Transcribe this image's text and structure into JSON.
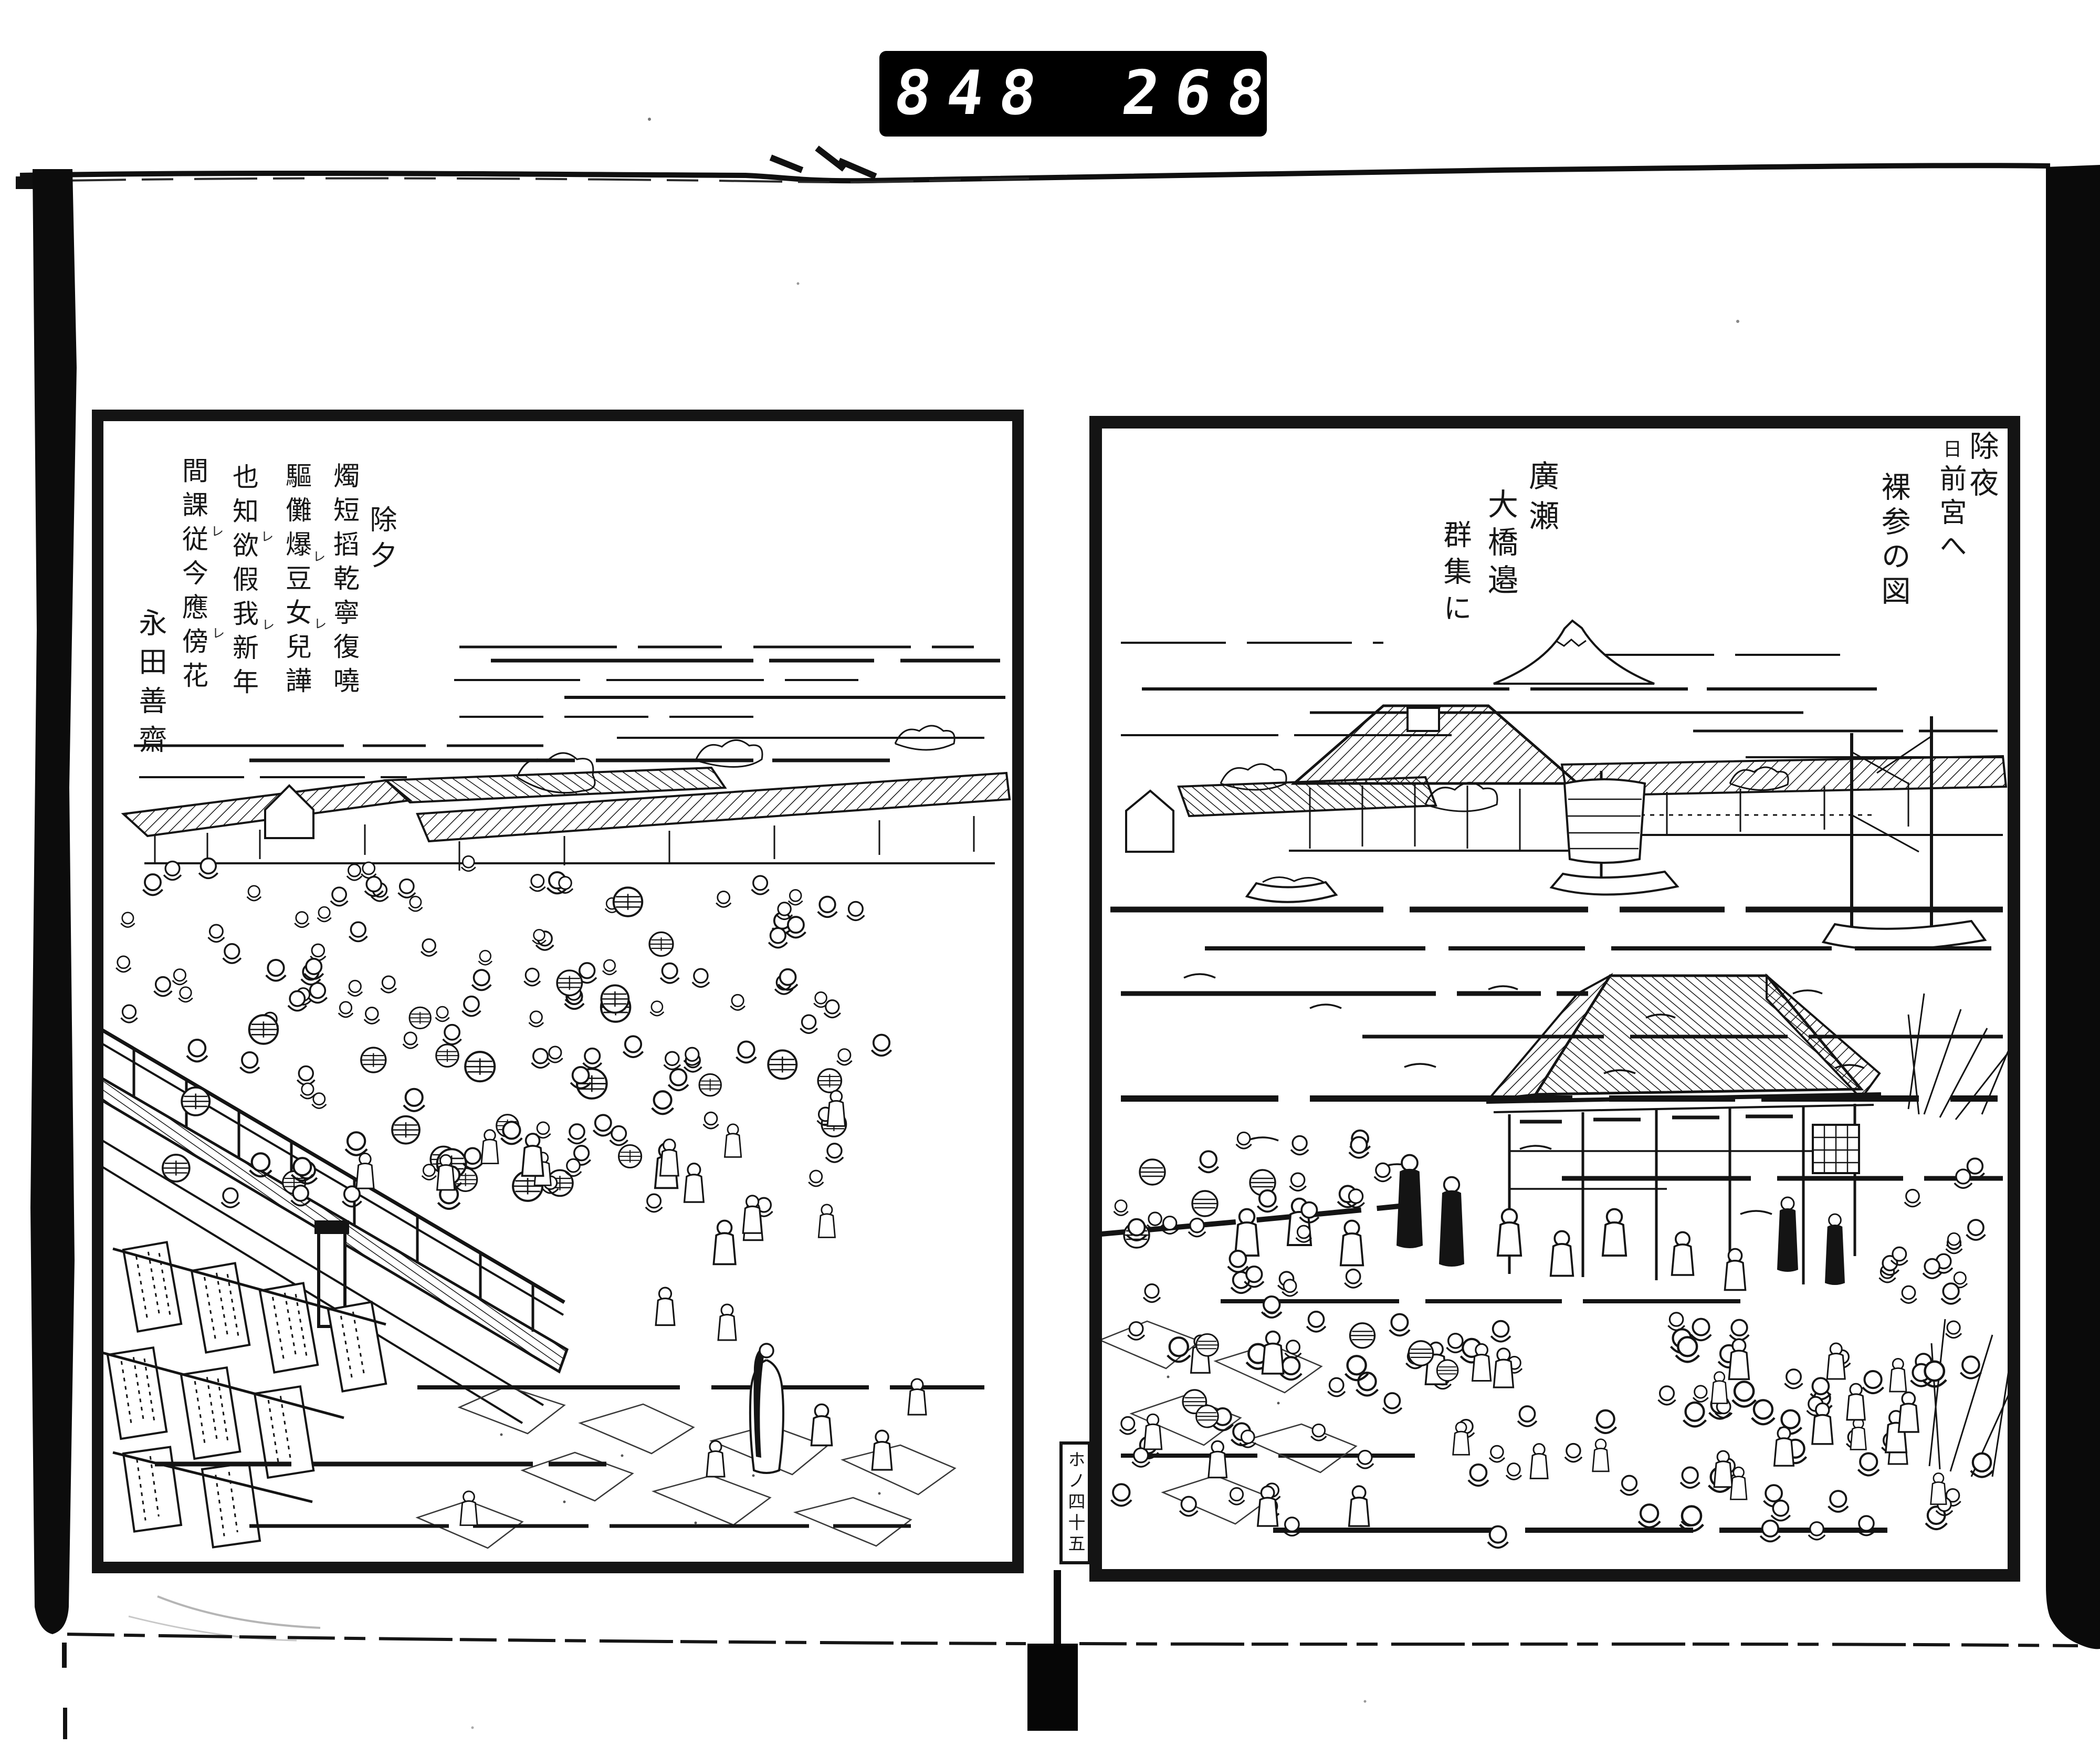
{
  "counter": {
    "left_value": "848",
    "right_value": "268."
  },
  "book": {
    "left_page": {
      "poem": {
        "title": "除夕",
        "lines": [
          "燭短搯乾寧復嘵",
          "驅儺爆豆女兒譁",
          "也知欲假我新年",
          "間課従今應傍花"
        ],
        "signature": "永田善齋",
        "kaeriten_mark": "レ"
      }
    },
    "right_page": {
      "title_col1": "除夜",
      "title_col2_head": "日",
      "title_col2_rest": "前宮へ",
      "title_col3": "裸参の図",
      "caption_col1": "廣瀬",
      "caption_col2": "大橋邉",
      "caption_col3": "群集に",
      "page_marker": "ホノ四十五"
    }
  },
  "colors": {
    "ink": "#141414",
    "paper": "#ffffff",
    "counter_bg": "#000000",
    "counter_digits": "#ffffff"
  }
}
